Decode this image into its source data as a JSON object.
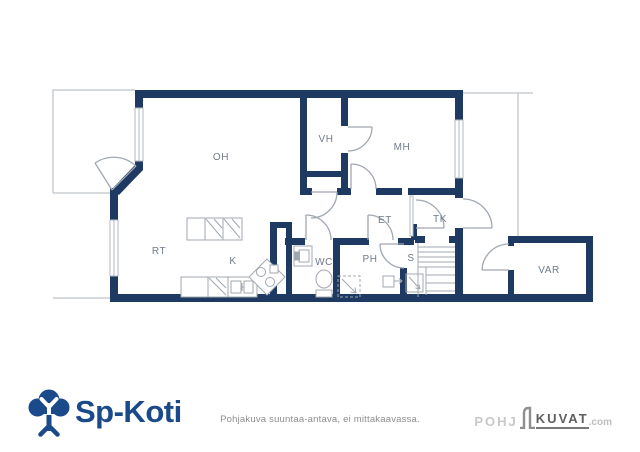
{
  "plan": {
    "rooms": {
      "oh": "OH",
      "vh": "VH",
      "mh": "MH",
      "et": "ET",
      "tk": "TK",
      "rt": "RT",
      "k": "K",
      "wc": "WC",
      "ph": "PH",
      "s": "S",
      "var": "VAR"
    }
  },
  "footer": {
    "brand": "Sp-Koti",
    "disclaimer": "Pohjakuva suuntaa-antava, ei mittakaavassa.",
    "watermark": {
      "pohj": "POHJ",
      "kuvat": "KUVAT",
      "dotcom": ".com"
    }
  },
  "colors": {
    "wall": "#1e3a63",
    "brand_blue": "#1b4a8a",
    "fixture_gray": "#a0a8b1",
    "outline_gray": "#c9cdd1",
    "label_gray": "#6f7b8a"
  }
}
